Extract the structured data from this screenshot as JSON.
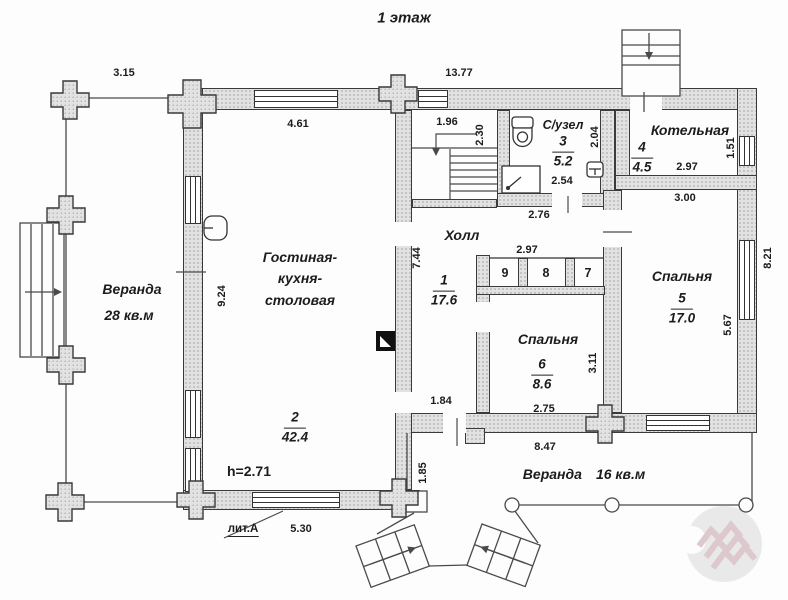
{
  "title": "1 этаж",
  "note_height": "h=2.71",
  "note_liter": "лит.А",
  "rooms": {
    "veranda_left": {
      "name": "Веранда",
      "area": "28 кв.м"
    },
    "living": {
      "name_line1": "Гостиная-",
      "name_line2": "кухня-",
      "name_line3": "столовая",
      "number": "2",
      "area": "42.4"
    },
    "hall": {
      "name": "Холл",
      "number": "1",
      "area": "17.6"
    },
    "bathroom": {
      "name": "С/узел",
      "number": "3",
      "area": "5.2"
    },
    "boiler": {
      "name": "Котельная",
      "number": "4",
      "area": "4.5"
    },
    "bedroom_right": {
      "name": "Спальня",
      "number": "5",
      "area": "17.0"
    },
    "bedroom_mid": {
      "name": "Спальня",
      "number": "6",
      "area": "8.6"
    },
    "closet_left": {
      "number": "9"
    },
    "closet_mid": {
      "number": "8"
    },
    "closet_right": {
      "number": "7"
    },
    "veranda_bottom": {
      "name": "Веранда",
      "area": "16 кв.м"
    }
  },
  "dimensions": {
    "d315": "3.15",
    "d1377": "13.77",
    "d461": "4.61",
    "d196": "1.96",
    "d230": "2.30",
    "d204": "2.04",
    "d254": "2.54",
    "d276": "2.76",
    "d297_boiler": "2.97",
    "d151": "1.51",
    "d300": "3.00",
    "d744": "7.44",
    "d184": "1.84",
    "d297_closets": "2.97",
    "d311": "3.11",
    "d275": "2.75",
    "d567": "5.67",
    "d821": "8.21",
    "d924": "9.24",
    "d185": "1.85",
    "d847": "8.47",
    "d530": "5.30"
  },
  "colors": {
    "wall_fill": "#e2e2e2",
    "line": "#3a3a3a",
    "watermark_gray": "#e6e6e6",
    "watermark_pink": "#d8bfc5"
  }
}
